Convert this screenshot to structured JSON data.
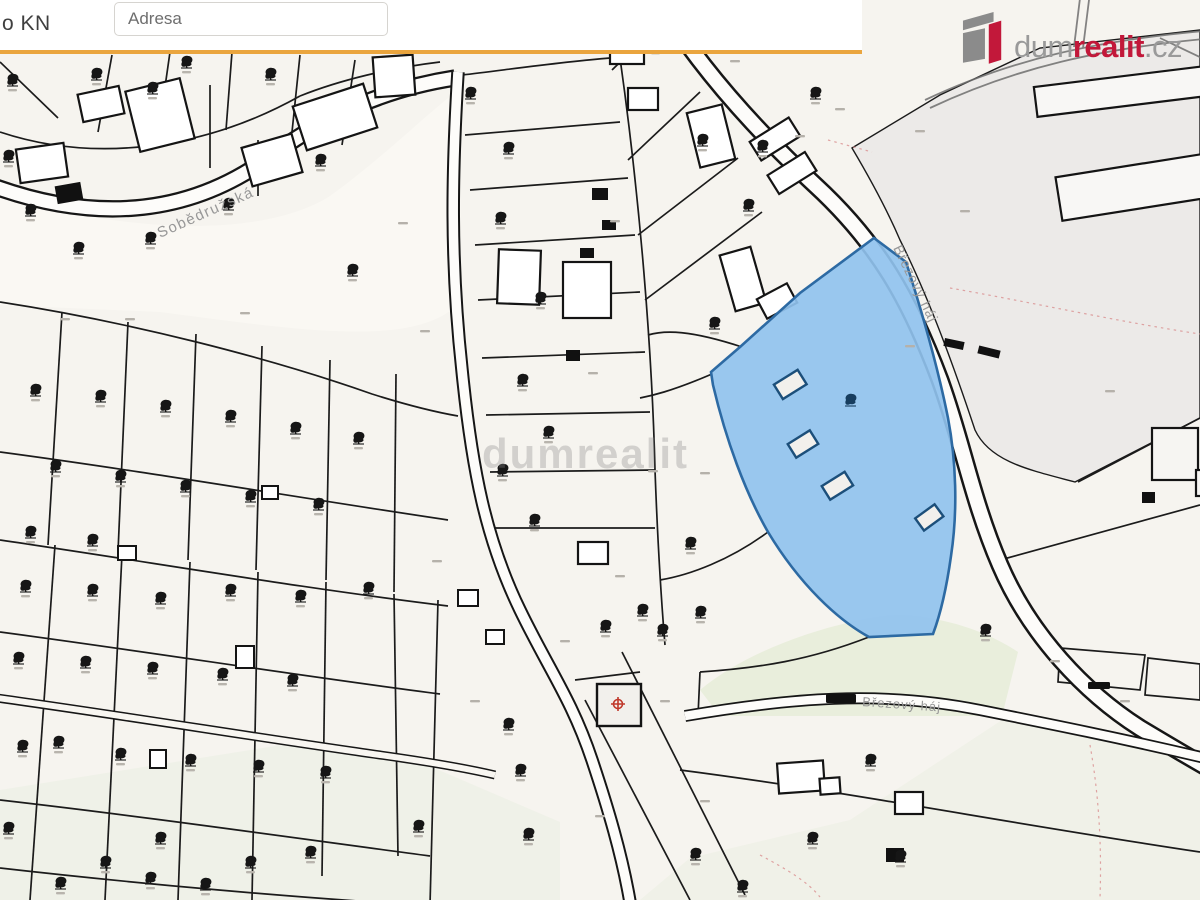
{
  "topbar": {
    "left_label_fragment": "o KN",
    "address_input": {
      "placeholder": "Adresa"
    },
    "accent_color": "#eaa53e"
  },
  "logo": {
    "text_gray_1": "dum",
    "text_red": "realit",
    "text_gray_2": ".cz",
    "brand_red": "#c2183a",
    "brand_gray": "#9a9a9a"
  },
  "map": {
    "street_labels": {
      "sobedruzska": "Sobědružská",
      "brezovy_haj_upper": "Březový háj",
      "brezovy_haj_lower": "Březový háj"
    },
    "watermark": "dumrealit",
    "highlight_fill": "#90c2ee",
    "highlight_border": "#2d6aa3",
    "background": "#f6f4ef",
    "parcel_line_color": "#1b1b1b"
  }
}
